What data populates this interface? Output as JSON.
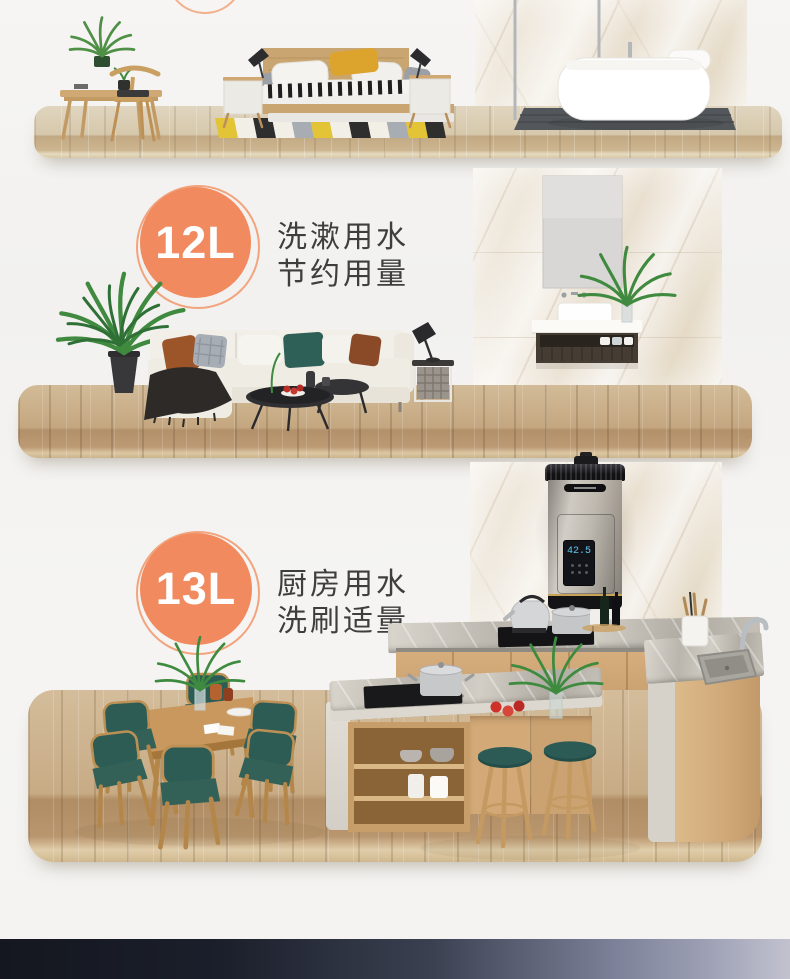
{
  "colors": {
    "accent_orange": "#f18a5e",
    "badge_text": "#ffffff",
    "feature_text": "#3e3e3e",
    "footer_strip_left": "#14171f",
    "footer_strip_right": "#c2c2cf"
  },
  "sections": {
    "living": {
      "badge_label": "12L",
      "feature_line1": "洗漱用水",
      "feature_line2": "节约用量"
    },
    "kitchen": {
      "badge_label": "13L",
      "feature_line1": "厨房用水",
      "feature_line2": "洗刷适量",
      "heater_display": "42.5"
    }
  }
}
